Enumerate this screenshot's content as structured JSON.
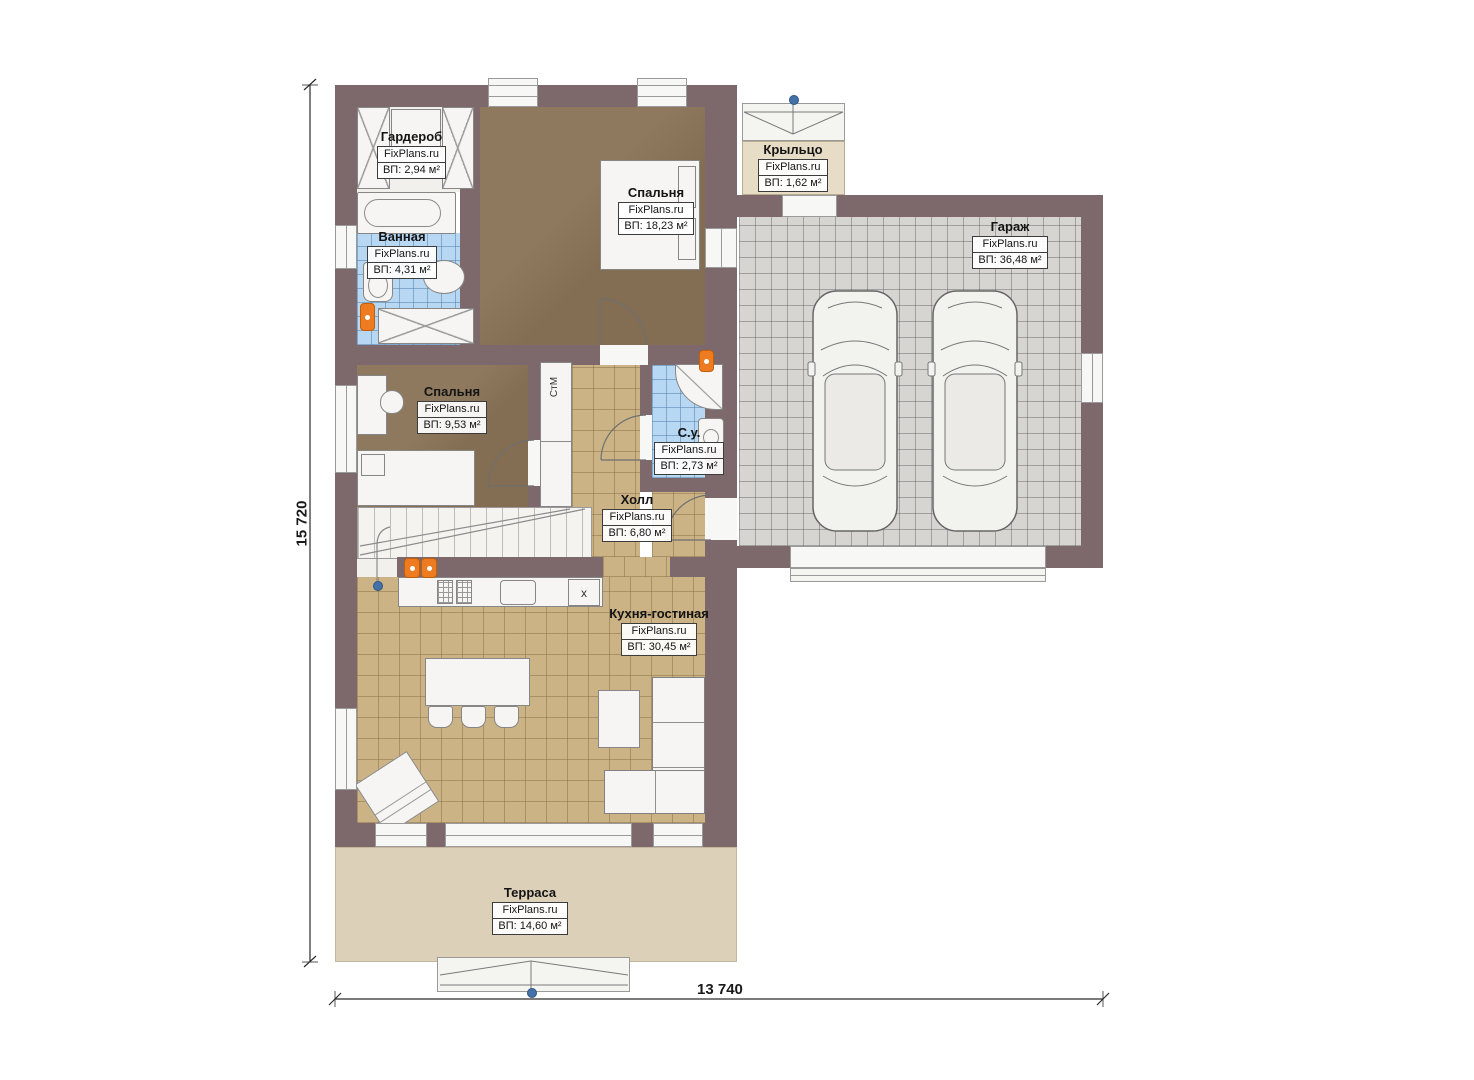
{
  "brand": "FixPlans.ru",
  "rooms": [
    {
      "name": "Гардероб",
      "area": "ВП: 2,94 м²"
    },
    {
      "name": "Ванная",
      "area": "ВП: 4,31 м²"
    },
    {
      "name": "Спальня",
      "area": "ВП: 18,23 м²"
    },
    {
      "name": "Крыльцо",
      "area": "ВП: 1,62 м²"
    },
    {
      "name": "Гараж",
      "area": "ВП: 36,48 м²"
    },
    {
      "name": "Спальня",
      "area": "ВП: 9,53 м²"
    },
    {
      "name": "С.у.",
      "area": "ВП: 2,73 м²"
    },
    {
      "name": "Холл",
      "area": "ВП: 6,80 м²"
    },
    {
      "name": "Кухня-гостиная",
      "area": "ВП: 30,45 м²"
    },
    {
      "name": "Терраса",
      "area": "ВП: 14,60 м²"
    }
  ],
  "dimensions": {
    "height": "15 720",
    "width": "13 740"
  },
  "misc": {
    "washing_machine": "СтМ",
    "appliance_mark": "х"
  },
  "palette": {
    "wall": "#7d686b",
    "floor_wood": "#8a7458",
    "floor_tile_tan": "#cbb385",
    "floor_tile_blue": "#b7d7f2",
    "floor_garage": "#d6d5d2",
    "terrace": "#ddd0b8",
    "radiator": "#ee7b20",
    "marker": "#4472a8"
  }
}
